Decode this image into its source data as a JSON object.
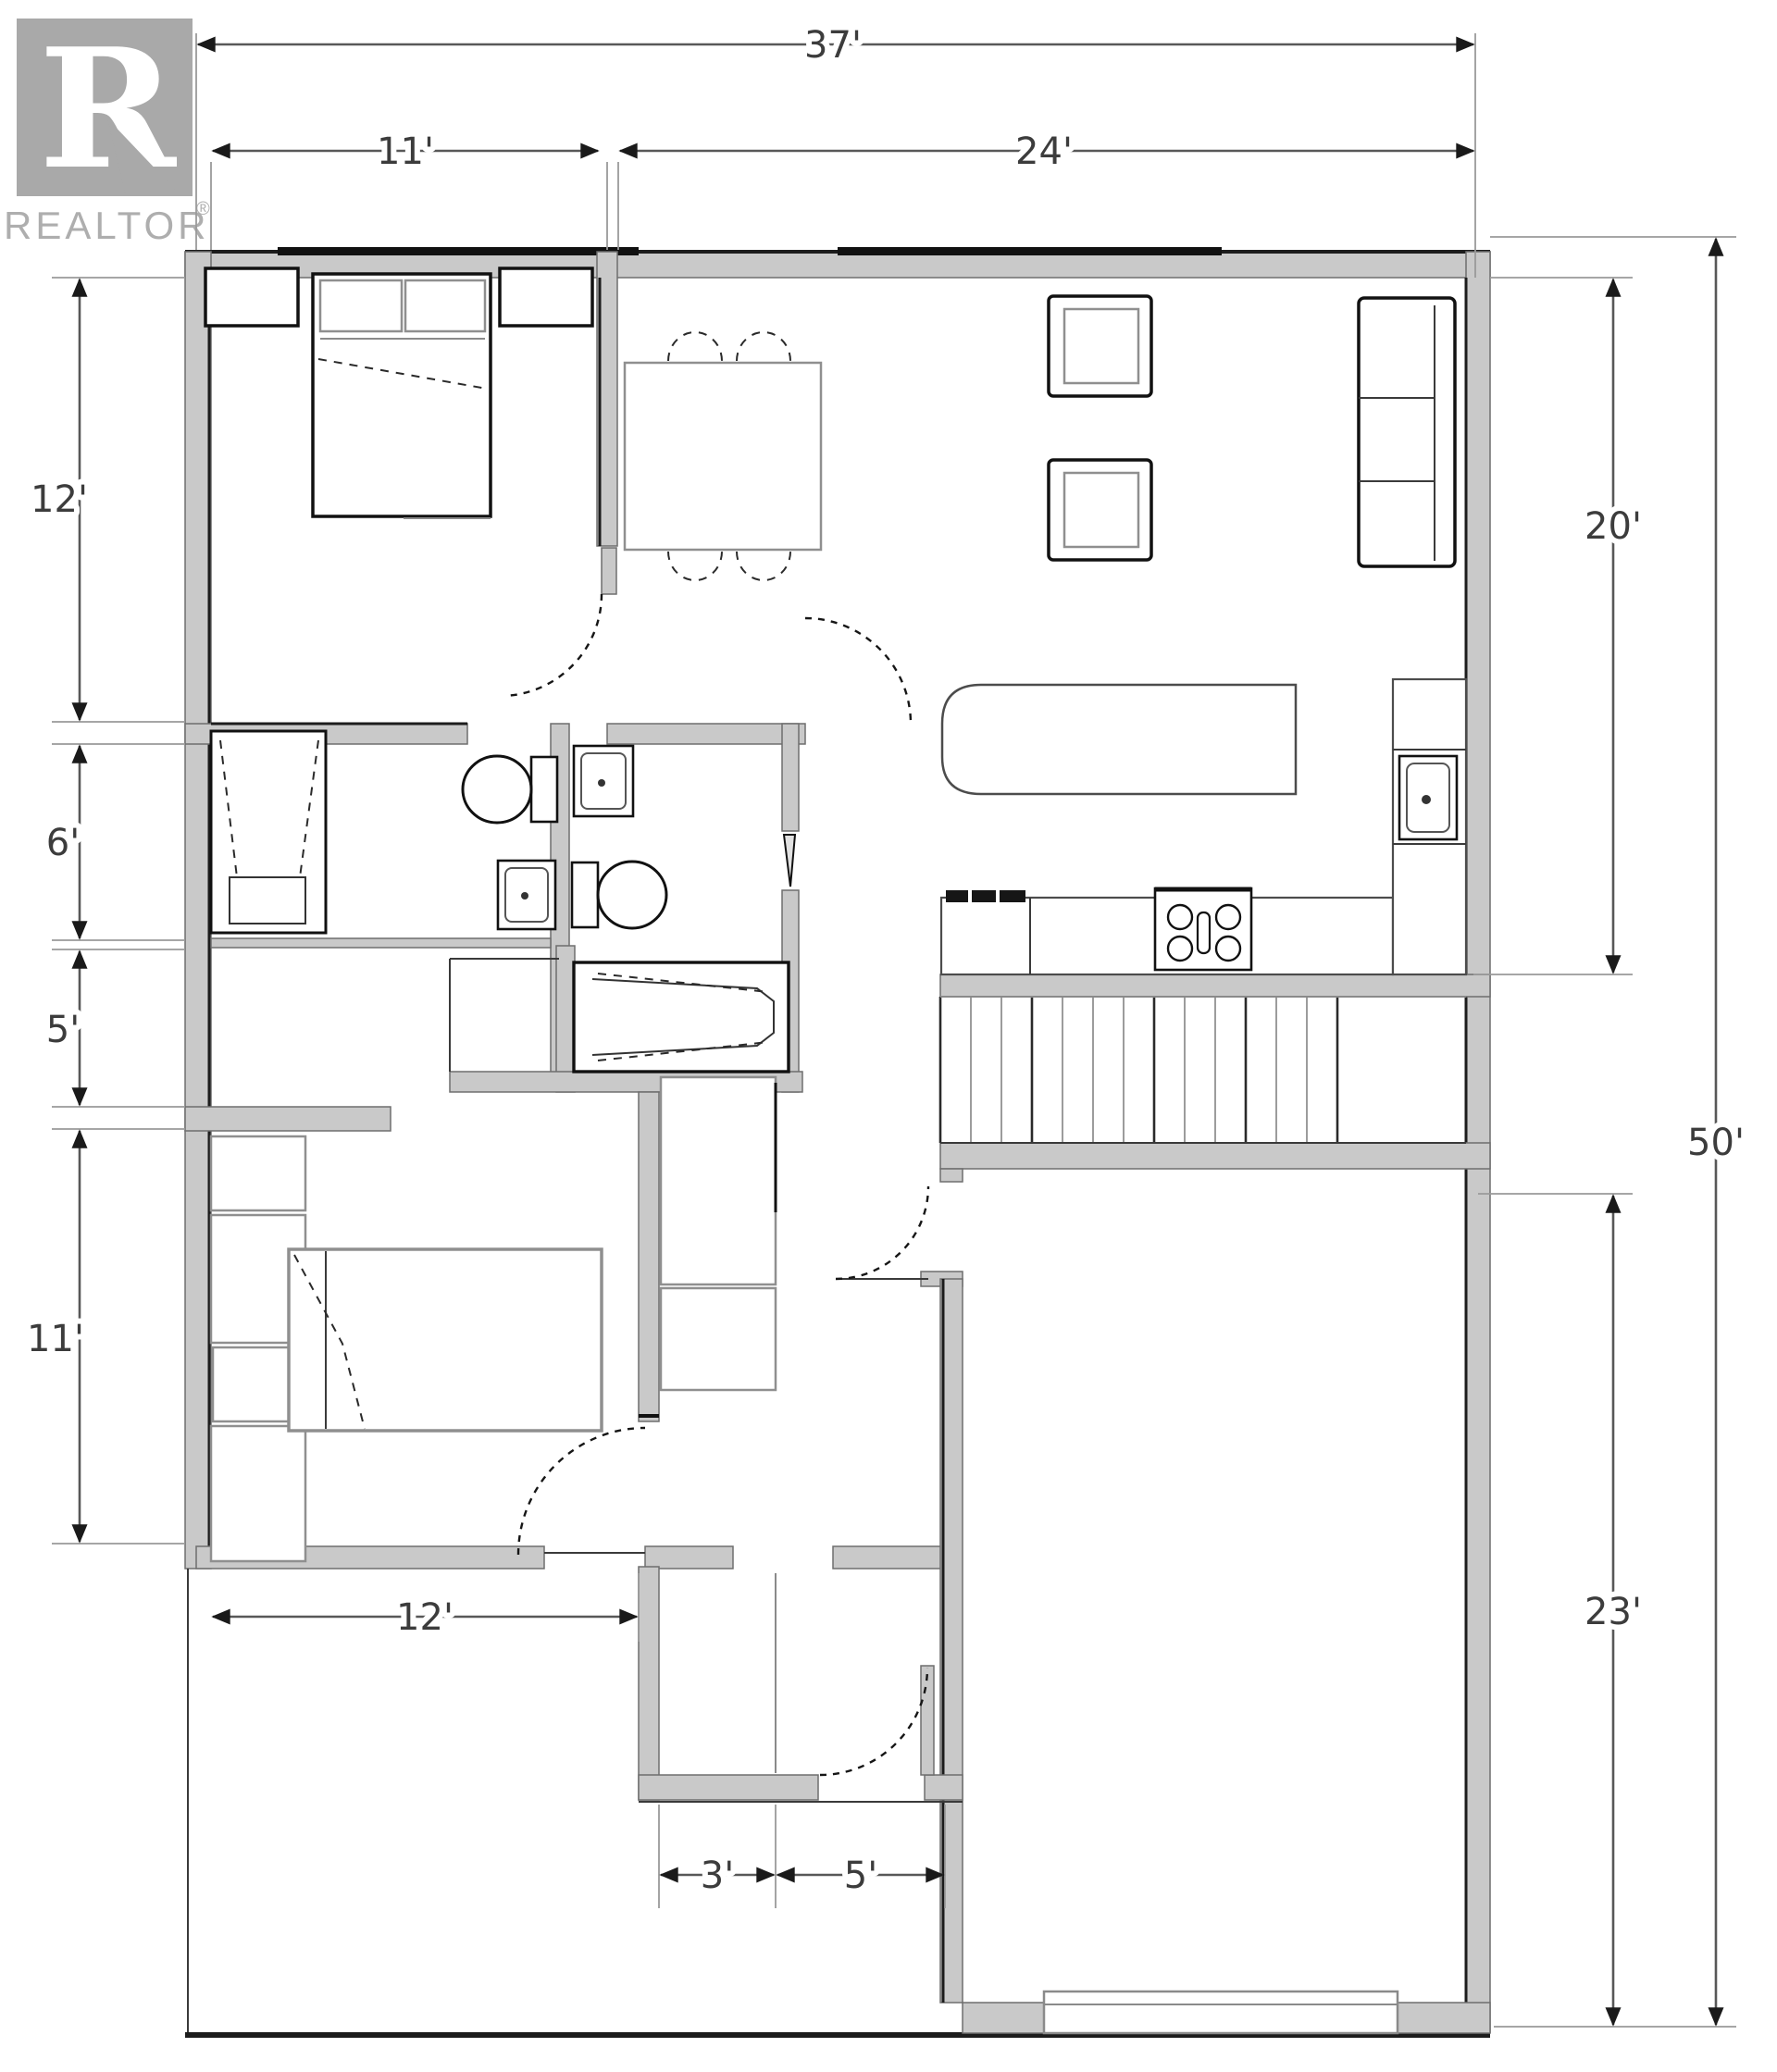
{
  "logo": {
    "letter_mark": "R",
    "brand": "REALTOR",
    "registered": "®"
  },
  "dimensions": {
    "top_width_total": "37'",
    "top_width_left": "11'",
    "top_width_right": "24'",
    "left_height_upper": "12'",
    "left_height_mid": "6'",
    "left_height_lower": "5'",
    "left_height_bottom": "11'",
    "right_height_upper": "20'",
    "right_height_total": "50'",
    "right_height_lower": "23'",
    "bottom_width_bedroom": "12'",
    "bottom_width_entry_left": "3'",
    "bottom_width_entry_right": "5'"
  },
  "elements": {
    "fixtures": [
      "bed",
      "nightstand",
      "pillows",
      "dining-table",
      "dining-chair",
      "armchair",
      "sofa",
      "kitchen-island",
      "cooktop",
      "kitchen-sink",
      "fridge-cabinet",
      "shower",
      "toilet",
      "bathroom-sink",
      "bathtub",
      "stairs",
      "closet",
      "garage-door",
      "entry-door",
      "interior-door"
    ],
    "colors": {
      "wall_fill": "#c9c9c9",
      "wall_edge": "#1c1c1c",
      "dim_line": "#585858",
      "logo_gray": "#a9a9a9"
    }
  }
}
